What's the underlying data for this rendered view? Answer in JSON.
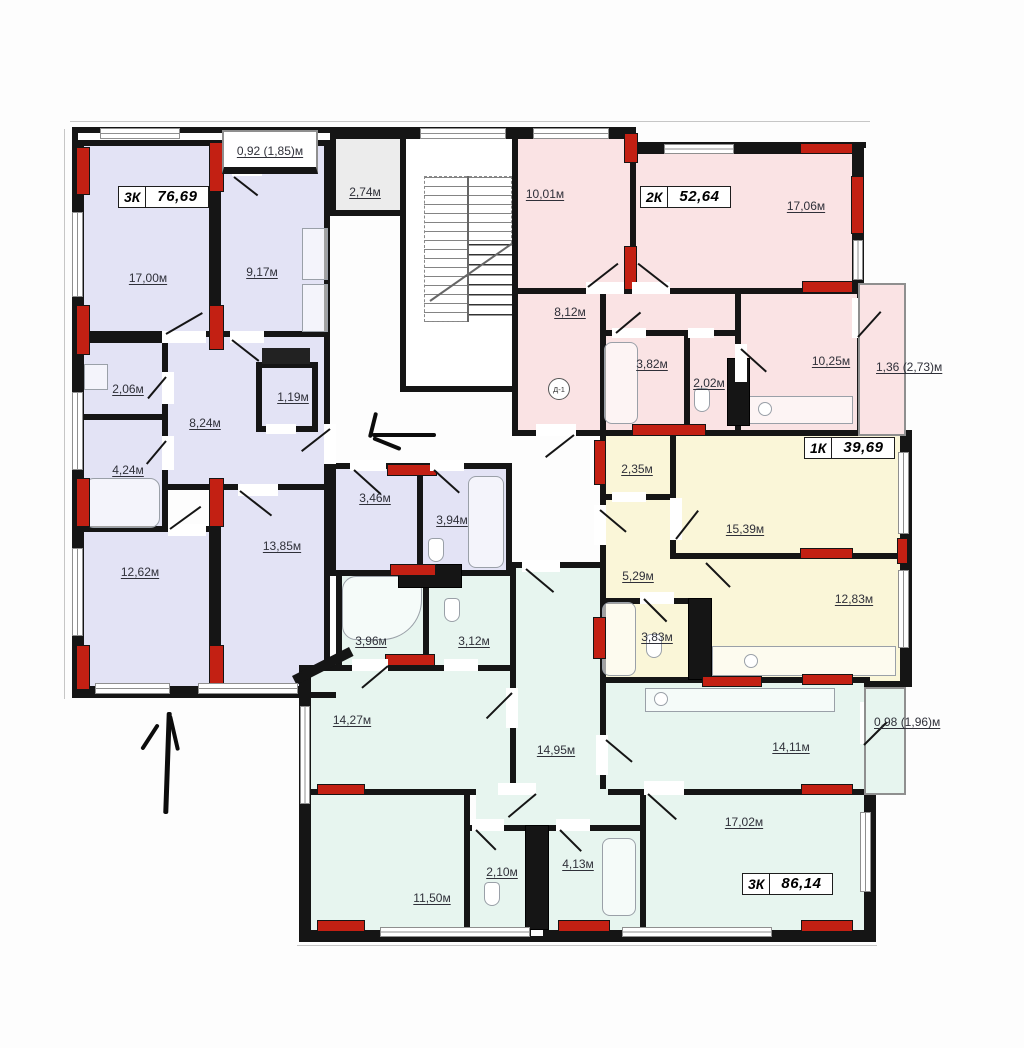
{
  "floor_plan": {
    "apartments": {
      "a1": {
        "type": "3К",
        "area": "76,69",
        "color": "#e3e3f5"
      },
      "a2": {
        "type": "2К",
        "area": "52,64",
        "color": "#fae3e4"
      },
      "a3": {
        "type": "1К",
        "area": "39,69",
        "color": "#faf6d8"
      },
      "a4": {
        "type": "3К",
        "area": "86,14",
        "color": "#e7f5ef"
      }
    },
    "rooms": {
      "r1700": "17,00м",
      "r0917": "9,17м",
      "r0206": "2,06м",
      "r0824": "8,24м",
      "r0119": "1,19м",
      "r0424": "4,24м",
      "r1262": "12,62м",
      "r1385": "13,85м",
      "r0346": "3,46м",
      "r0394": "3,94м",
      "r0274": "2,74м",
      "r1001": "10,01м",
      "r1706": "17,06м",
      "r0812": "8,12м",
      "r0382": "3,82м",
      "r0202": "2,02м",
      "r1025": "10,25м",
      "r0235": "2,35м",
      "r1539": "15,39м",
      "r0529": "5,29м",
      "r1283": "12,83м",
      "r0383": "3,83м",
      "r0396": "3,96м",
      "r0312": "3,12м",
      "r1427": "14,27м",
      "r1495": "14,95м",
      "r1411": "14,11м",
      "r1702": "17,02м",
      "r1150": "11,50м",
      "r0210": "2,10м",
      "r0413": "4,13м"
    },
    "balconies": {
      "top": "0,92 (1,85)м",
      "right_pink": "1,36 (2,73)м",
      "right_green": "0,98 (1,96)м"
    },
    "door_mark": "Д-1",
    "colors": {
      "wall": "#151515",
      "pier": "#c32013"
    }
  }
}
